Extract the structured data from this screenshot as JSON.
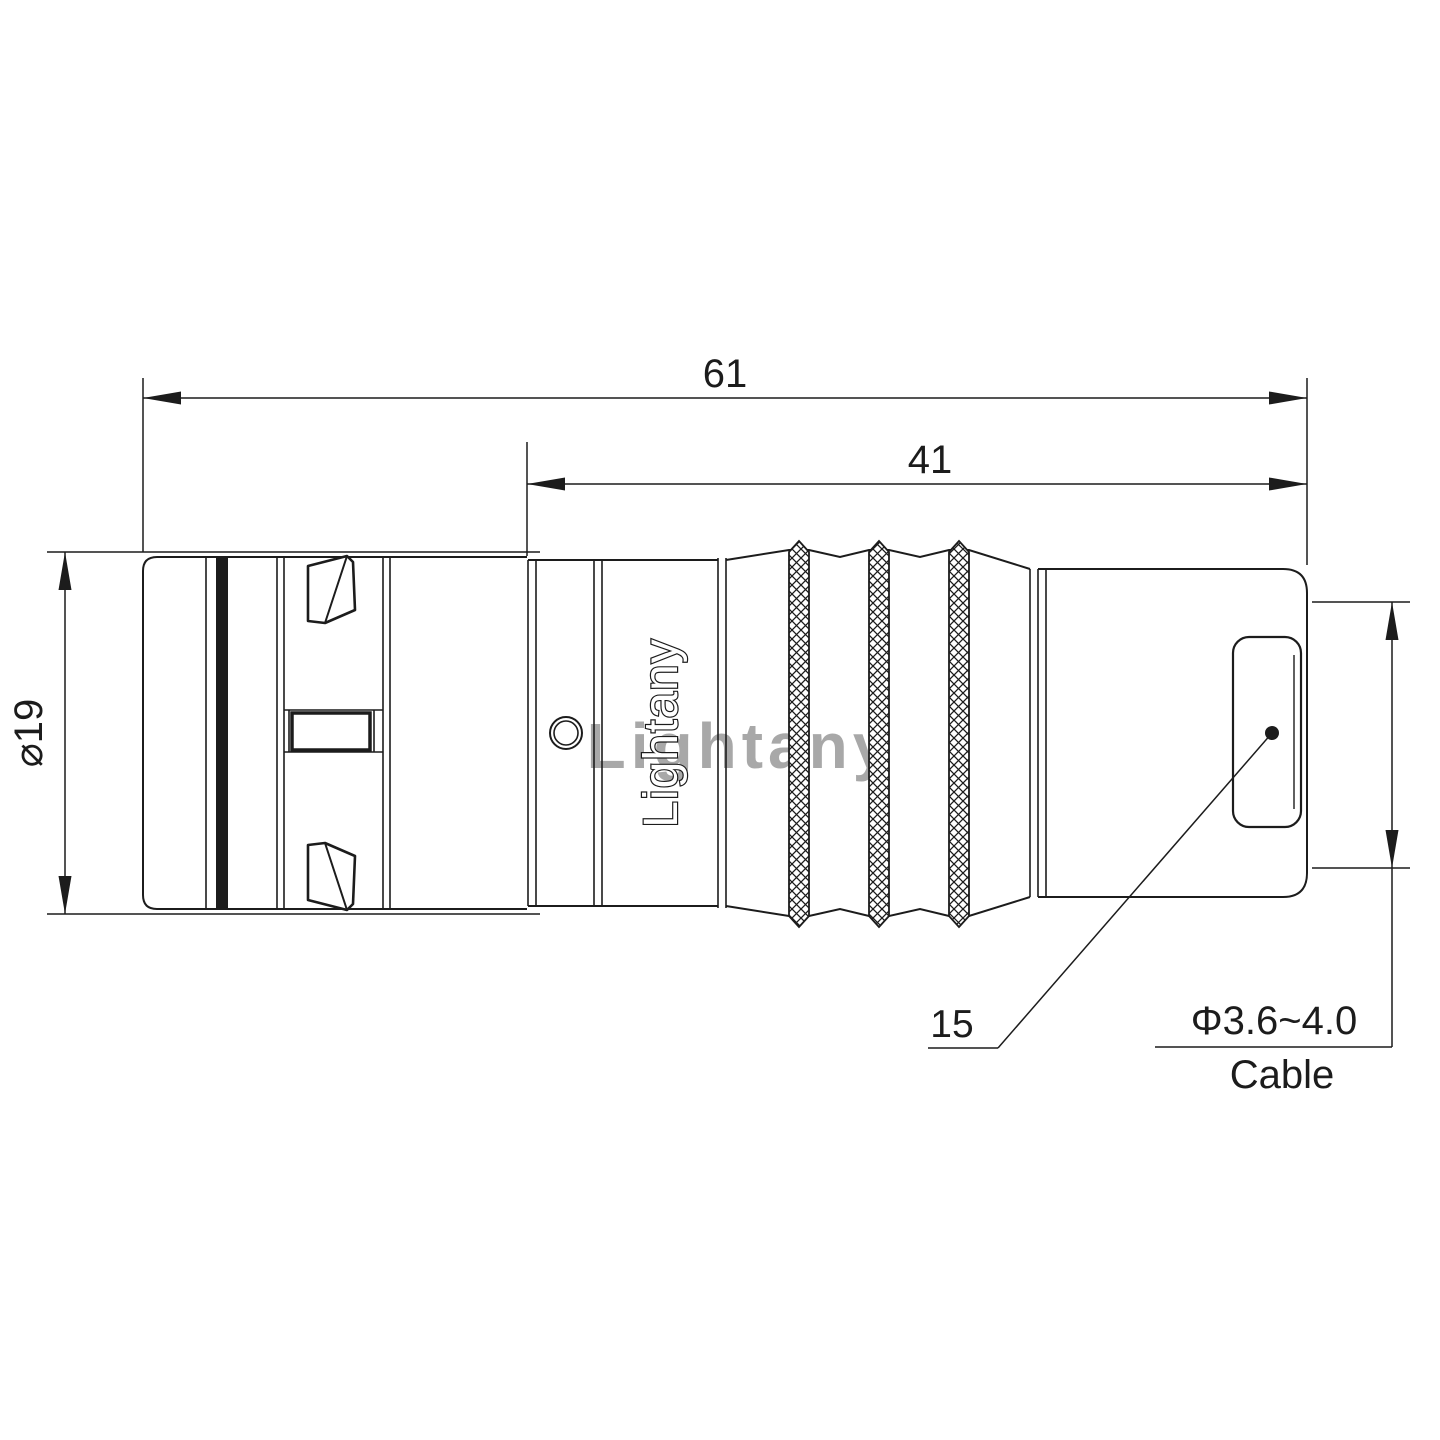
{
  "drawing": {
    "type": "connector-technical-drawing",
    "labels": {
      "total_length": "61",
      "sleeve_length": "41",
      "outer_diameter": "⌀19",
      "nut_callout": "15",
      "cable_range": "Φ3.6~4.0",
      "cable_word": "Cable"
    },
    "branding": {
      "marking": "Lightany",
      "watermark": "Lightany"
    },
    "colors": {
      "line": "#1c1c1c",
      "watermark_pink": "#d96c6c",
      "background": "#ffffff"
    }
  }
}
